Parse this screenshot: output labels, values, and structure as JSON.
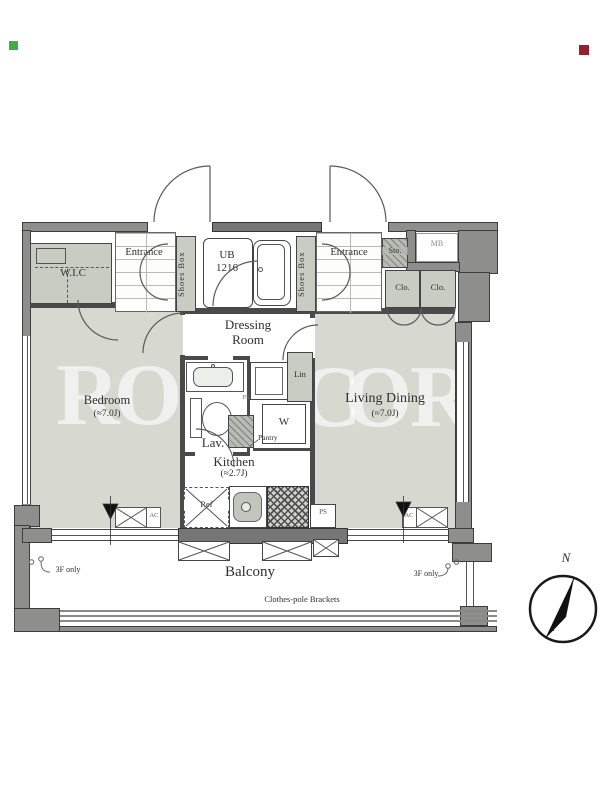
{
  "rooms": {
    "bedroom": {
      "label": "Bedroom",
      "size": "(≈7.0J)"
    },
    "living_dining": {
      "label": "Living Dining",
      "size": "(≈7.0J)"
    },
    "kitchen": {
      "label": "Kitchen",
      "size": "(≈2.7J)"
    },
    "dressing_room": {
      "line1": "Dressing",
      "line2": "Room"
    },
    "lavatory": {
      "label": "Lav."
    },
    "unit_bath": {
      "line1": "UB",
      "line2": "1216"
    },
    "balcony": {
      "label": "Balcony"
    },
    "entrance_left": "Entrance",
    "entrance_right": "Entrance",
    "wic": "W.I.C"
  },
  "storage": {
    "shoes_box_left": "Shoes Box",
    "shoes_box_right": "Shoes Box",
    "sto": "Sto.",
    "closet_left": "Clo.",
    "closet_right": "Clo.",
    "linen": "Lin",
    "pantry": "Pantry"
  },
  "fixtures": {
    "washing_machine": "W",
    "refrigerator": "Ref",
    "meter_box": "MB",
    "pipe_space_upper": "PS",
    "pipe_space_lower": "PS",
    "ac_left": "AC",
    "ac_right": "AC"
  },
  "annotations": {
    "clothes_pole_brackets": "Clothes-pole Brackets",
    "floor_note_left": "3F only",
    "floor_note_right": "3F only",
    "north": "N"
  },
  "watermark": {
    "letters": [
      "R",
      "O",
      "C",
      "O",
      "R"
    ]
  },
  "colors": {
    "room_fill": "#d7d9d1",
    "closet_fill": "#c9ccc3",
    "wall_gray": "#8e8f8d",
    "wall_dark": "#757675",
    "marker_green": "#3fae49",
    "marker_red": "#94212e"
  }
}
